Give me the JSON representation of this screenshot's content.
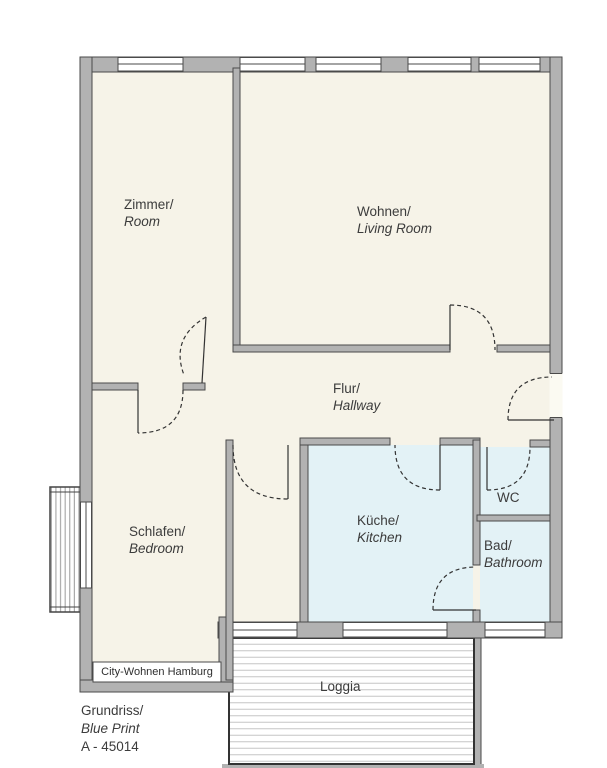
{
  "plan": {
    "rooms": [
      {
        "key": "zimmer",
        "label_de": "Zimmer/",
        "label_en": "Room"
      },
      {
        "key": "wohnen",
        "label_de": "Wohnen/",
        "label_en": "Living Room"
      },
      {
        "key": "flur",
        "label_de": "Flur/",
        "label_en": "Hallway"
      },
      {
        "key": "schlafen",
        "label_de": "Schlafen/",
        "label_en": "Bedroom"
      },
      {
        "key": "kueche",
        "label_de": "Küche/",
        "label_en": "Kitchen"
      },
      {
        "key": "wc",
        "label_de": "WC",
        "label_en": ""
      },
      {
        "key": "bad",
        "label_de": "Bad/",
        "label_en": "Bathroom"
      },
      {
        "key": "loggia",
        "label_de": "Loggia",
        "label_en": ""
      }
    ],
    "watermark": "City-Wohnen Hamburg",
    "caption": {
      "line1": "Grundriss/",
      "line2": "Blue Print",
      "line3": "A - 45014"
    },
    "colors": {
      "room_fill": "#f6f3e8",
      "wet_room_fill": "#e3f2f6",
      "wall_fill": "#b2b2b2",
      "wall_outline": "#4a4a4a",
      "loggia_hatch": "#c6c6c6",
      "text": "#3c3c3c"
    }
  }
}
